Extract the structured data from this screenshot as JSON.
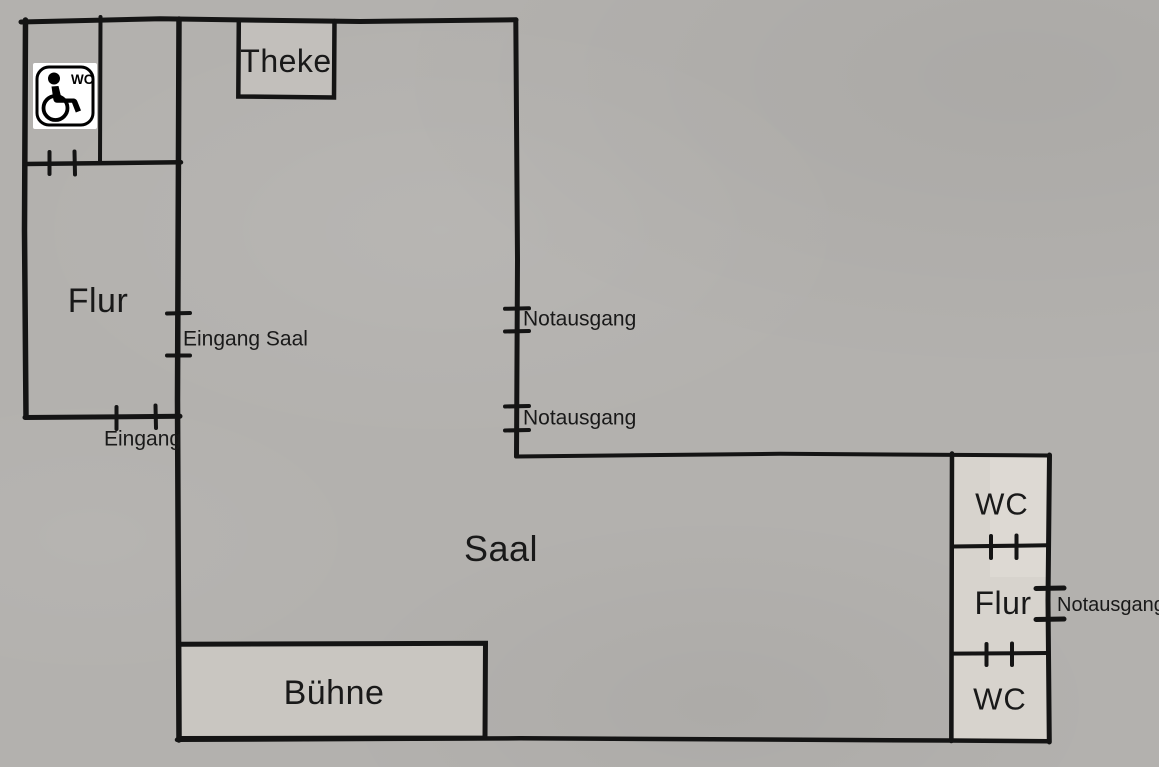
{
  "colors": {
    "background": "#b3b1ae",
    "wall": "#141414",
    "text": "#191919",
    "room_light_fill": "#d7d3cd",
    "stage_fill": "#c9c6c1",
    "counter_fill": "#c2bfbb",
    "sign_background": "#ffffff",
    "sign_foreground": "#000000"
  },
  "rooms": {
    "theke": "Theke",
    "flur_left": "Flur",
    "saal": "Saal",
    "buehne": "Bühne",
    "wc_top_right": "WC",
    "flur_right": "Flur",
    "wc_bottom_right": "WC"
  },
  "doors": {
    "eingang": "Eingang",
    "eingang_saal": "Eingang Saal",
    "notausgang_saal_top": "Notausgang",
    "notausgang_saal_mid": "Notausgang",
    "notausgang_right": "Notausgang"
  },
  "sign": {
    "wc": "WC"
  }
}
